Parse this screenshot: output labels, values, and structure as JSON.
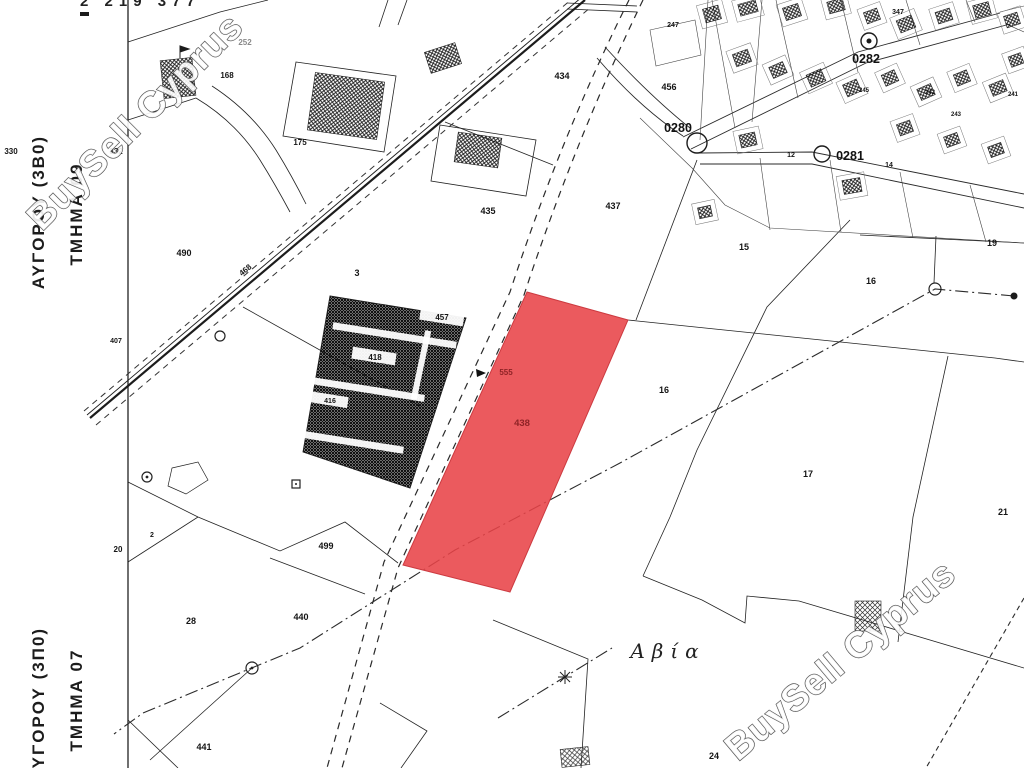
{
  "map": {
    "sheet_reference": "2 219 377",
    "watermark": {
      "text": "BuySell Cyprus"
    },
    "place_name": {
      "text": "Αβία",
      "x": 668,
      "y": 658
    },
    "region_labels": [
      {
        "name": "region-label-avgorou-09",
        "text": "ΑΥΓΟΡΟΥ (3Β0)",
        "x": 44,
        "y": 212
      },
      {
        "name": "section-label-tmima-09",
        "text": "ΤΜΗΜΑ 09",
        "x": 82,
        "y": 214
      },
      {
        "name": "region-label-avgorou-07",
        "text": "ΑΥΓΟΡΟΥ (3Π0)",
        "x": 44,
        "y": 704
      },
      {
        "name": "section-label-tmima-07",
        "text": "ΤΜΗΜΑ 07",
        "x": 82,
        "y": 700
      }
    ],
    "highlighted_parcel": {
      "number": "438",
      "number_x": 522,
      "number_y": 426,
      "secondary_number": "555",
      "secondary_x": 506,
      "secondary_y": 375,
      "fill": "#e84348",
      "label_color": "#8f2326"
    },
    "survey_points": [
      {
        "label": "0280",
        "cx": 697,
        "cy": 143,
        "r": 10,
        "lx": 678,
        "ly": 132
      },
      {
        "label": "0281",
        "cx": 822,
        "cy": 154,
        "r": 8,
        "lx": 850,
        "ly": 160
      },
      {
        "label": "0282",
        "cx": 869,
        "cy": 41,
        "r": 8,
        "lx": 866,
        "ly": 63
      }
    ],
    "parcel_labels": [
      {
        "text": "252",
        "x": 245,
        "y": 45,
        "size": 8,
        "color": "#8a8a8a"
      },
      {
        "text": "168",
        "x": 227,
        "y": 78,
        "size": 8
      },
      {
        "text": "175",
        "x": 300,
        "y": 145,
        "size": 8
      },
      {
        "text": "330",
        "x": 11,
        "y": 154,
        "size": 8
      },
      {
        "text": "332",
        "x": 116,
        "y": 154,
        "size": 8
      },
      {
        "text": "490",
        "x": 184,
        "y": 256,
        "size": 9
      },
      {
        "text": "468",
        "x": 247,
        "y": 272,
        "size": 8,
        "rotate": -40
      },
      {
        "text": "3",
        "x": 357,
        "y": 276,
        "size": 9
      },
      {
        "text": "407",
        "x": 116,
        "y": 343,
        "size": 7
      },
      {
        "text": "434",
        "x": 562,
        "y": 79,
        "size": 9
      },
      {
        "text": "456",
        "x": 669,
        "y": 90,
        "size": 9
      },
      {
        "text": "247",
        "x": 673,
        "y": 27,
        "size": 7
      },
      {
        "text": "435",
        "x": 488,
        "y": 214,
        "size": 9
      },
      {
        "text": "437",
        "x": 613,
        "y": 209,
        "size": 9
      },
      {
        "text": "457",
        "x": 442,
        "y": 320,
        "size": 8
      },
      {
        "text": "418",
        "x": 375,
        "y": 360,
        "size": 8
      },
      {
        "text": "416",
        "x": 330,
        "y": 403,
        "size": 7
      },
      {
        "text": "20",
        "x": 118,
        "y": 552,
        "size": 8
      },
      {
        "text": "2",
        "x": 152,
        "y": 537,
        "size": 7
      },
      {
        "text": "28",
        "x": 191,
        "y": 624,
        "size": 9
      },
      {
        "text": "499",
        "x": 326,
        "y": 549,
        "size": 9
      },
      {
        "text": "440",
        "x": 301,
        "y": 620,
        "size": 9
      },
      {
        "text": "441",
        "x": 204,
        "y": 750,
        "size": 9
      },
      {
        "text": "15",
        "x": 744,
        "y": 250,
        "size": 9
      },
      {
        "text": "16",
        "x": 871,
        "y": 284,
        "size": 9
      },
      {
        "text": "19",
        "x": 992,
        "y": 246,
        "size": 9
      },
      {
        "text": "16",
        "x": 664,
        "y": 393,
        "size": 9
      },
      {
        "text": "17",
        "x": 808,
        "y": 477,
        "size": 9
      },
      {
        "text": "21",
        "x": 1003,
        "y": 515,
        "size": 9
      },
      {
        "text": "24",
        "x": 714,
        "y": 759,
        "size": 9
      },
      {
        "text": "12",
        "x": 791,
        "y": 157,
        "size": 7
      },
      {
        "text": "14",
        "x": 889,
        "y": 167,
        "size": 7
      },
      {
        "text": "347",
        "x": 898,
        "y": 14,
        "size": 7
      },
      {
        "text": "245",
        "x": 864,
        "y": 92,
        "size": 6
      },
      {
        "text": "242",
        "x": 930,
        "y": 94,
        "size": 6
      },
      {
        "text": "243",
        "x": 956,
        "y": 116,
        "size": 6
      },
      {
        "text": "241",
        "x": 1013,
        "y": 96,
        "size": 6
      }
    ],
    "colors": {
      "highlight_red": "#e84348",
      "line_black": "#1c1c1c",
      "watermark_outline": "#4f4f4f"
    }
  }
}
